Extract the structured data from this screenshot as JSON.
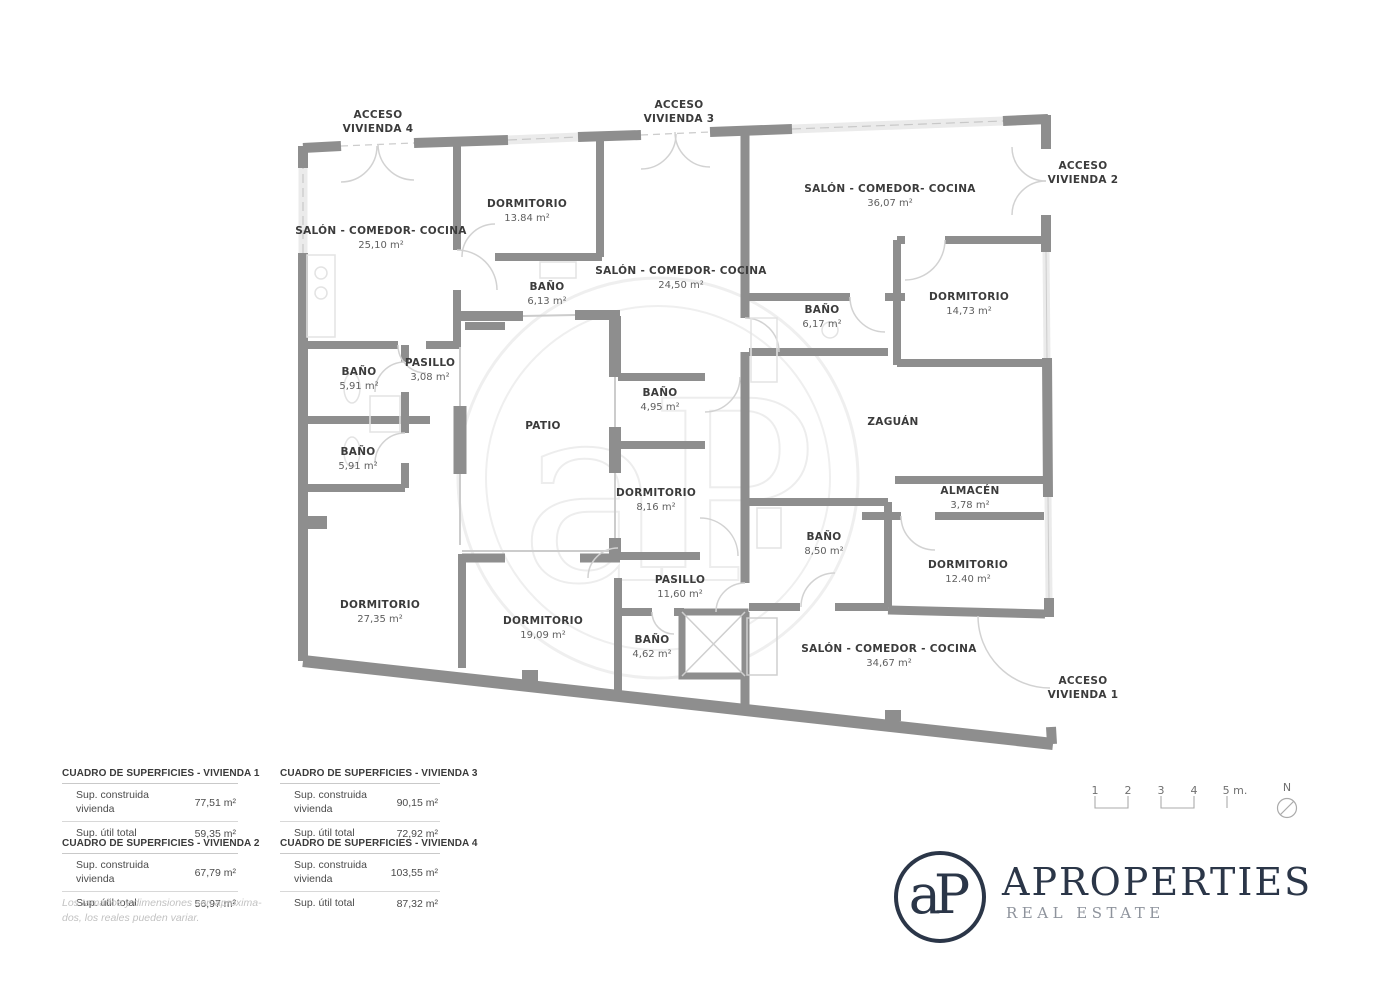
{
  "plan": {
    "accesses": [
      {
        "text": "ACCESO\nVIVIENDA 4"
      },
      {
        "text": "ACCESO\nVIVIENDA 3"
      },
      {
        "text": "ACCESO\nVIVIENDA 2"
      },
      {
        "text": "ACCESO\nVIVIENDA 1"
      }
    ],
    "rooms": [
      {
        "name": "SALÓN - COMEDOR- COCINA",
        "area": "25,10 m²"
      },
      {
        "name": "DORMITORIO",
        "area": "13.84 m²"
      },
      {
        "name": "BAÑO",
        "area": "6,13 m²"
      },
      {
        "name": "SALÓN - COMEDOR- COCINA",
        "area": "24,50 m²"
      },
      {
        "name": "SALÓN - COMEDOR- COCINA",
        "area": "36,07 m²"
      },
      {
        "name": "BAÑO",
        "area": "6,17 m²"
      },
      {
        "name": "DORMITORIO",
        "area": "14,73 m²"
      },
      {
        "name": "BAÑO",
        "area": "5,91 m²"
      },
      {
        "name": "PASILLO",
        "area": "3,08 m²"
      },
      {
        "name": "BAÑO",
        "area": "5,91 m²"
      },
      {
        "name": "PATIO",
        "area": ""
      },
      {
        "name": "BAÑO",
        "area": "4,95 m²"
      },
      {
        "name": "ZAGUÁN",
        "area": ""
      },
      {
        "name": "DORMITORIO",
        "area": "8,16 m²"
      },
      {
        "name": "ALMACÉN",
        "area": "3,78 m²"
      },
      {
        "name": "BAÑO",
        "area": "8,50 m²"
      },
      {
        "name": "DORMITORIO",
        "area": "12.40 m²"
      },
      {
        "name": "DORMITORIO",
        "area": "27,35 m²"
      },
      {
        "name": "DORMITORIO",
        "area": "19,09 m²"
      },
      {
        "name": "PASILLO",
        "area": "11,60 m²"
      },
      {
        "name": "BAÑO",
        "area": "4,62 m²"
      },
      {
        "name": "SALÓN - COMEDOR - COCINA",
        "area": "34,67 m²"
      }
    ]
  },
  "surface_tables": [
    {
      "title": "CUADRO DE SUPERFICIES - VIVIENDA 1",
      "rows": [
        {
          "label": "Sup. construida\nvivienda",
          "value": "77,51 m²"
        },
        {
          "label": "Sup. útil total",
          "value": "59,35 m²"
        }
      ]
    },
    {
      "title": "CUADRO DE SUPERFICIES - VIVIENDA 2",
      "rows": [
        {
          "label": "Sup. construida\nvivienda",
          "value": "67,79 m²"
        },
        {
          "label": "Sup. útil total",
          "value": "56,97 m²"
        }
      ]
    },
    {
      "title": "CUADRO DE SUPERFICIES - VIVIENDA 3",
      "rows": [
        {
          "label": "Sup. construida\nvivienda",
          "value": "90,15 m²"
        },
        {
          "label": "Sup. útil total",
          "value": "72,92 m²"
        }
      ]
    },
    {
      "title": "CUADRO DE SUPERFICIES - VIVIENDA 4",
      "rows": [
        {
          "label": "Sup. construida\nvivienda",
          "value": "103,55 m²"
        },
        {
          "label": "Sup. útil total",
          "value": "87,32 m²"
        }
      ]
    }
  ],
  "disclaimer": "Los tamaños y dimensiones son aproxima-\ndos, los reales pueden variar.",
  "scale_bar": {
    "marks": [
      "1",
      "2",
      "3",
      "4",
      "5 m."
    ],
    "north_label": "N"
  },
  "logo": {
    "monogram": "aP",
    "name": "APROPERTIES",
    "tagline": "REAL ESTATE"
  },
  "colors": {
    "wall_gray": "#8e8e8e",
    "logo_navy": "#2b3648",
    "label_text": "#3b3b3b",
    "door_arc": "#d2d2d2"
  }
}
